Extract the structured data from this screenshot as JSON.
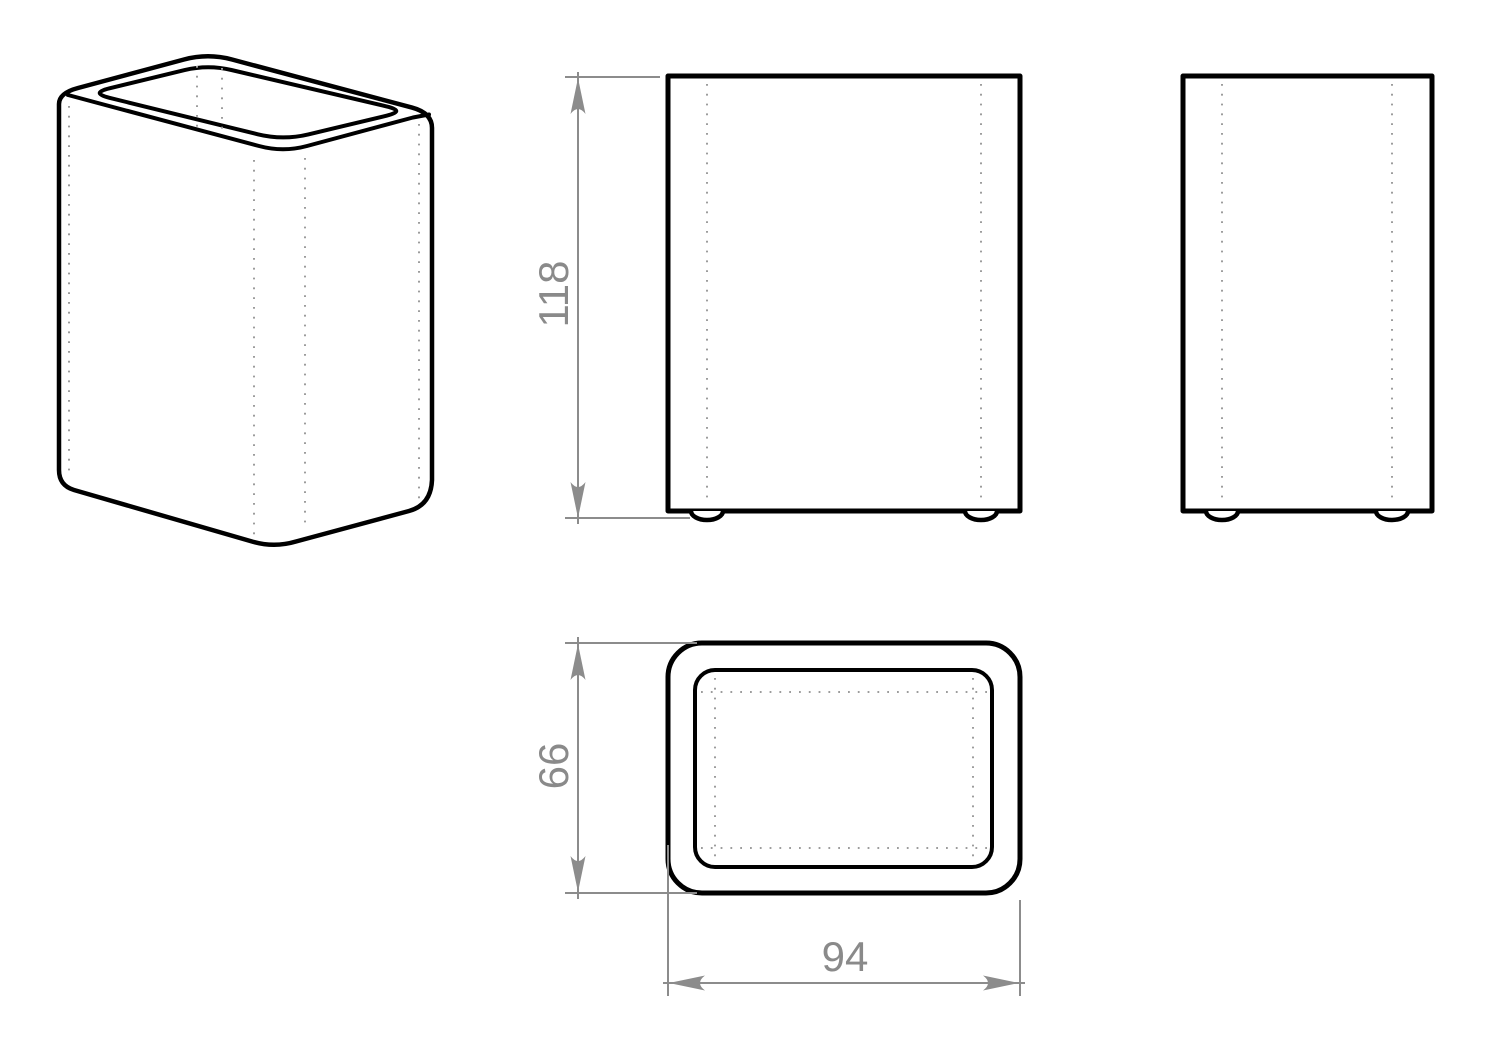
{
  "dimensions": {
    "height": {
      "value": "118"
    },
    "depth": {
      "value": "66"
    },
    "width": {
      "value": "94"
    }
  },
  "colors": {
    "background": "#ffffff",
    "object_line": "#000000",
    "dimension_line": "#8c8c8c",
    "dimension_text": "#8a8a8a",
    "hidden_dotted_line": "#9c9c9c"
  }
}
